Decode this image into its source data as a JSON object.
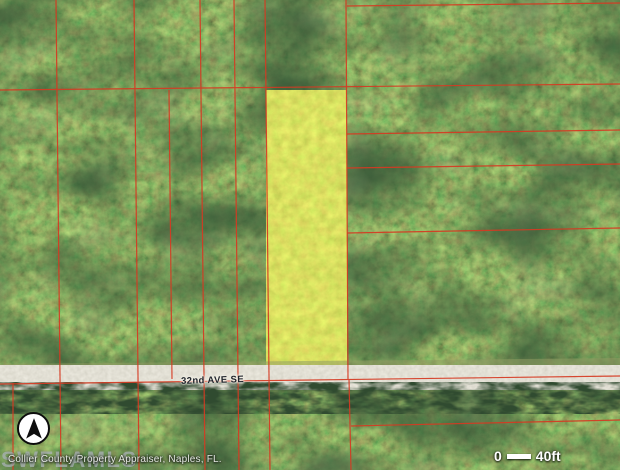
{
  "map": {
    "road_label": "32nd AVE SE",
    "watermark": "SWFLAMLS",
    "attribution": "Collier County Property Appraiser, Naples, FL.",
    "scale_bar": {
      "start_label": "0",
      "end_label": "40ft"
    },
    "colors": {
      "parcel_line": "#d63a22",
      "highlight_fill": "#b9c72f",
      "road_fill": "#c6c2af",
      "canopy_base": "#31412a"
    },
    "highlight_parcel": {
      "x": 266,
      "y": 90,
      "width": 81,
      "height": 289
    },
    "parcel_lines": {
      "vertical": [
        {
          "x1": 56,
          "y1": 0,
          "x2": 61,
          "y2": 470
        },
        {
          "x1": 134,
          "y1": 0,
          "x2": 139,
          "y2": 470
        },
        {
          "x1": 169,
          "y1": 90,
          "x2": 172,
          "y2": 379
        },
        {
          "x1": 200,
          "y1": 0,
          "x2": 205,
          "y2": 470
        },
        {
          "x1": 234,
          "y1": 0,
          "x2": 239,
          "y2": 470
        },
        {
          "x1": 265,
          "y1": 0,
          "x2": 270,
          "y2": 470
        },
        {
          "x1": 346,
          "y1": 0,
          "x2": 348,
          "y2": 379
        },
        {
          "x1": 349,
          "y1": 379,
          "x2": 351,
          "y2": 470
        },
        {
          "x1": 13,
          "y1": 383,
          "x2": 13,
          "y2": 470
        }
      ],
      "horizontal": [
        {
          "x1": 0,
          "y1": 90,
          "x2": 620,
          "y2": 84
        },
        {
          "x1": 347,
          "y1": 6,
          "x2": 620,
          "y2": 3
        },
        {
          "x1": 347,
          "y1": 134,
          "x2": 620,
          "y2": 130
        },
        {
          "x1": 347,
          "y1": 168,
          "x2": 620,
          "y2": 164
        },
        {
          "x1": 347,
          "y1": 233,
          "x2": 620,
          "y2": 228
        },
        {
          "x1": 0,
          "y1": 384,
          "x2": 620,
          "y2": 376
        },
        {
          "x1": 351,
          "y1": 426,
          "x2": 620,
          "y2": 420
        }
      ]
    }
  }
}
